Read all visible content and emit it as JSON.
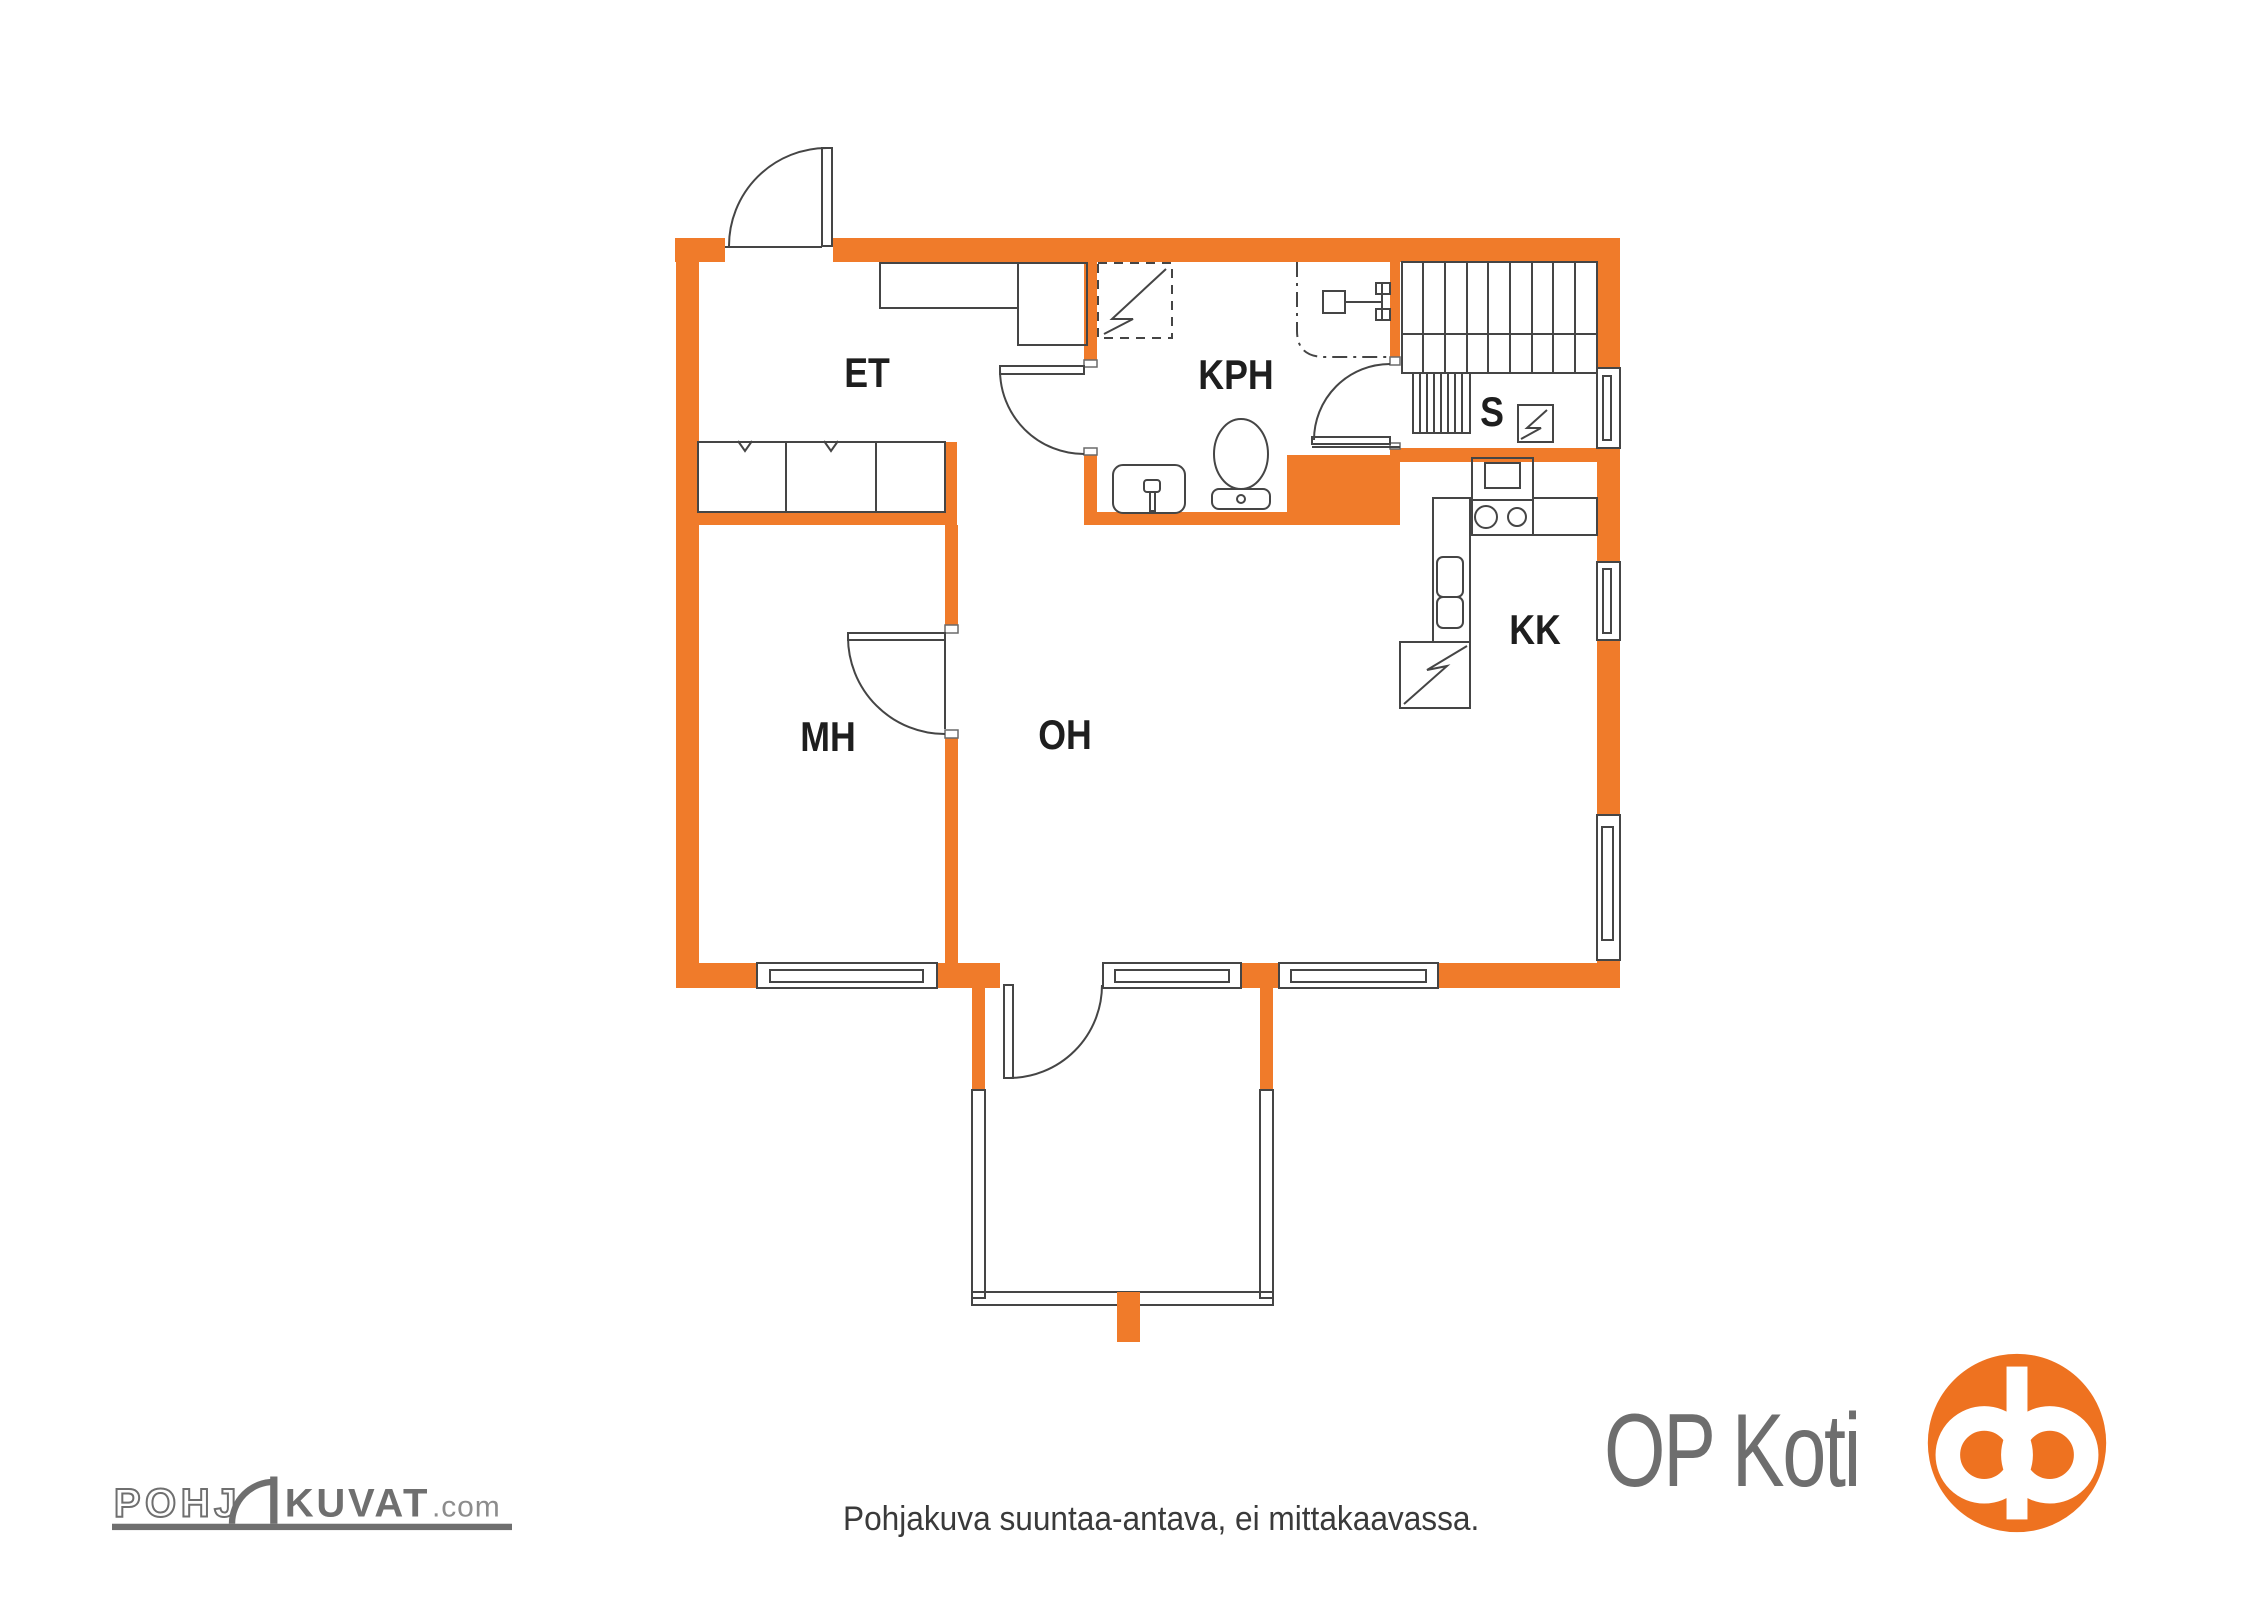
{
  "page": {
    "background": "#ffffff"
  },
  "floor_plan": {
    "title": "apartment-floor-plan",
    "rooms": [
      {
        "id": "et",
        "label": "ET"
      },
      {
        "id": "kph",
        "label": "KPH"
      },
      {
        "id": "sauna",
        "label": "S"
      },
      {
        "id": "kk",
        "label": "KK"
      },
      {
        "id": "mh",
        "label": "MH"
      },
      {
        "id": "oh",
        "label": "OH"
      }
    ]
  },
  "footer": {
    "disclaimer": "Pohjakuva suuntaa-antava, ei mittakaavassa.",
    "pohjakuvat_logo": {
      "part_outline": "POHJ",
      "part_solid": "KUVAT",
      "suffix": ".com"
    },
    "op_koti": {
      "wordmark": "OP Koti"
    }
  },
  "colors": {
    "wall_orange": "#F07B2A",
    "op_orange": "#EE7220",
    "logo_gray": "#6F6F6F",
    "line_dark": "#454545",
    "label_text": "#1E1E1E"
  }
}
